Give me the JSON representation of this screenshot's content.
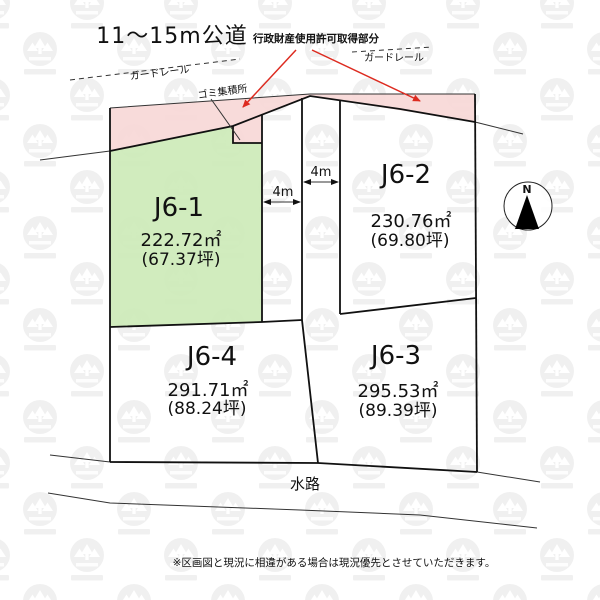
{
  "diagram": {
    "title": "11〜15m公道",
    "road_note": "行政財産使用許可取得部分",
    "guardrail_left": "ガードレール",
    "guardrail_right": "ガードレール",
    "garbage_station": "ゴミ集積所",
    "dim_left": "4m",
    "dim_right": "4m",
    "waterway": "水路",
    "compass_north": "N",
    "footer_note": "※区画図と現況に相違がある場合は現況優先とさせていただきます。"
  },
  "plots": [
    {
      "id": "J6-1",
      "area_sqm": "222.72㎡",
      "area_tsubo": "(67.37坪)",
      "highlighted": true
    },
    {
      "id": "J6-2",
      "area_sqm": "230.76㎡",
      "area_tsubo": "(69.80坪)",
      "highlighted": false
    },
    {
      "id": "J6-3",
      "area_sqm": "295.53㎡",
      "area_tsubo": "(89.39坪)",
      "highlighted": false
    },
    {
      "id": "J6-4",
      "area_sqm": "291.71㎡",
      "area_tsubo": "(88.24坪)",
      "highlighted": false
    }
  ],
  "colors": {
    "road_area_pink": "#f7d8d7",
    "highlight_green": "#cdeab8",
    "annotation_red": "#dd2b20"
  }
}
